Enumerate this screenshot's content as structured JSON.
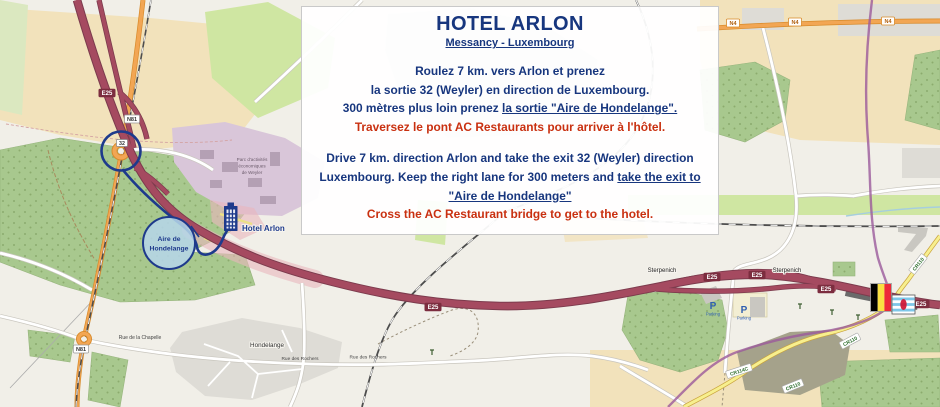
{
  "info_box": {
    "title": "HOTEL ARLON",
    "subtitle": "Messancy - Luxembourg",
    "fr": {
      "line1": "Roulez 7 km. vers Arlon et prenez",
      "line2": "la sortie 32 (Weyler) en direction de Luxembourg.",
      "line3_pre": "300 mètres plus loin prenez ",
      "line3_bold": "la sortie \"Aire de Hondelange\".",
      "line4": "Traversez le pont AC Restaurants pour arriver à l'hôtel."
    },
    "en": {
      "line1": "Drive 7 km. direction Arlon and take the exit 32 (Weyler) direction",
      "line2_pre": "Luxembourg. Keep the right lane for 300 meters and ",
      "line2_bold": "take the exit to",
      "line3_bold": "\"Aire de Hondelange\"",
      "line4": "Cross the AC Restaurant bridge to get to the hotel."
    }
  },
  "annotations": {
    "hotel_label": "Hotel Arlon",
    "aire_line1": "Aire de",
    "aire_line2": "Hondelange"
  },
  "map": {
    "labels": {
      "sterpenich": "Sterpenich",
      "hondelange": "Hondelange",
      "rue_chapelle": "Rue de la Chapelle",
      "rue_rochers": "Rue des Rochers",
      "parc_line1": "Parc d'activités",
      "parc_line2": "économiques",
      "parc_line3": "de Weyler",
      "parking_p": "P",
      "parking": "Parking"
    },
    "badges": {
      "e25": "E25",
      "n4": "N4",
      "n81": "N81",
      "cr110": "CR110",
      "cr114c": "CR114C",
      "exit": "32"
    }
  },
  "colors": {
    "navy_text": "#17367e",
    "red_text": "#c93010",
    "motorway_red": "#a54a60",
    "trunk_orange": "#f2a654",
    "annotation_navy": "#1e3a8c",
    "aire_bubble_fill": "#b5d6e9"
  }
}
